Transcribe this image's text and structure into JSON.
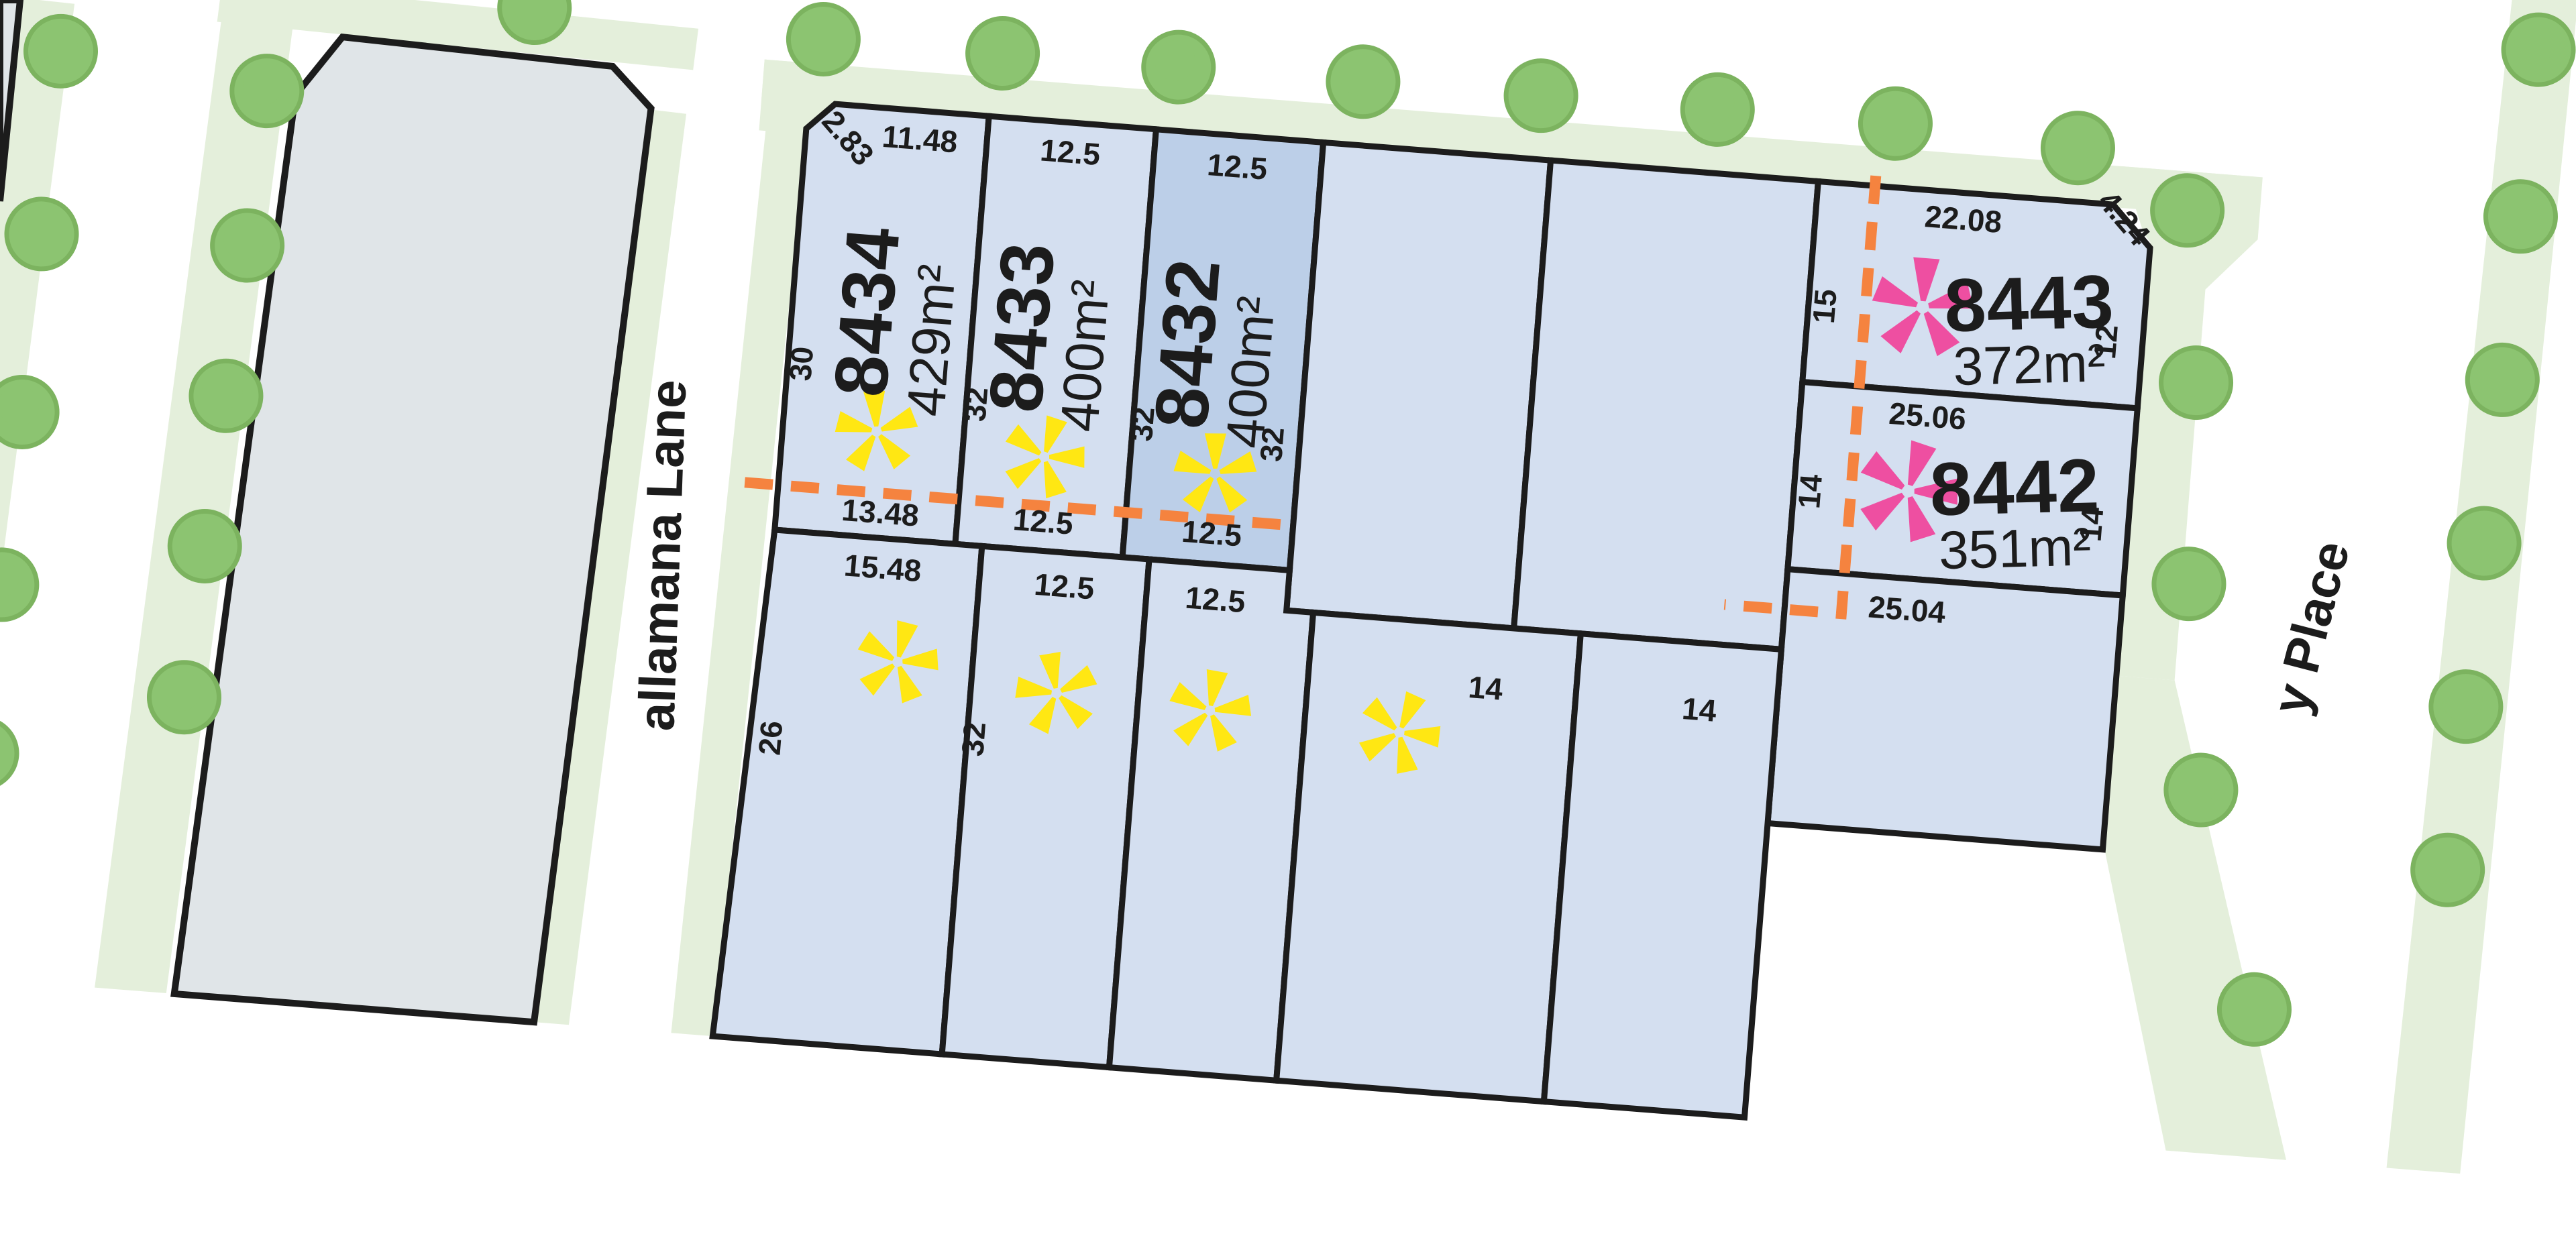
{
  "title": "Residential estate subdivision plan",
  "streets": {
    "lane": "allamana Lane",
    "place": "y Place"
  },
  "colors": {
    "road": "#ffffff",
    "verge": "#e4efdb",
    "tree_fill": "#8cc471",
    "tree_inner": "#a3d58b",
    "tree_stroke": "#7cb35f",
    "reserve": "#e0e5e8",
    "lot": "#d4dff0",
    "lot_highlight": "#bccfe8",
    "outline": "#1c1c1c",
    "dash": "#f5833f",
    "star_yellow": "#ffe713",
    "star_pink": "#ee4fa1"
  },
  "lots": {
    "l8434": {
      "number": "8434",
      "area": "429m²",
      "dim_top": "11.48",
      "dim_chamfer": "2.83",
      "dim_left": "30",
      "dim_bottom": "13.48"
    },
    "l8433": {
      "number": "8433",
      "area": "400m²",
      "dim_top": "12.5",
      "dim_left": "32",
      "dim_bottom": "12.5"
    },
    "l8432": {
      "number": "8432",
      "area": "400m²",
      "dim_top": "12.5",
      "dim_left": "32",
      "dim_right": "32",
      "dim_bottom": "12.5"
    },
    "l8443": {
      "number": "8443",
      "area": "372m²",
      "dim_top": "22.08",
      "dim_chamfer": "4.24",
      "dim_left": "15",
      "dim_right": "12"
    },
    "l8442": {
      "number": "8442",
      "area": "351m²",
      "dim_top": "25.06",
      "dim_left": "14",
      "dim_right": "14"
    },
    "below_8442": {
      "dim_top": "25.04"
    },
    "row2_1": {
      "dim_top": "15.48",
      "dim_left": "26"
    },
    "row2_2": {
      "dim_top": "12.5",
      "dim_side_partial": "32"
    },
    "row2_3": {
      "dim_top": "12.5"
    },
    "row2_4": {
      "dim_top": "14"
    },
    "row2_5": {
      "dim_top": "14"
    }
  },
  "markers": {
    "yellow_star_lots": [
      "8434",
      "8433",
      "8432",
      "row2_1",
      "row2_2",
      "row2_3",
      "row2_4"
    ],
    "pink_star_lots": [
      "8443",
      "8442"
    ]
  }
}
